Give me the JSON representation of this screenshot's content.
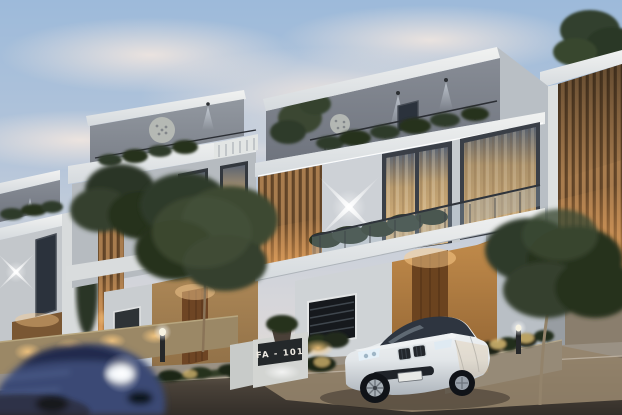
{
  "scene": {
    "description": "Dusk exterior rendering of a modern gated villa community with warm landscape lighting, a white luxury sedan parked in a driveway and a motion-blurred blue car passing on the street",
    "sign": {
      "label": "FA - 101"
    },
    "palette": {
      "sky_top": "#9dbada",
      "sky_horizon": "#e9dfd6",
      "facade_white": "#f1f2f1",
      "facade_gray": "#878c95",
      "wood_slats": "#a87c4e",
      "window_warm": "#e0b97e",
      "accent_light_warm": "#ffcd86",
      "accent_light_cool": "#eef4fb",
      "foliage_dark": "#2f3a2a",
      "road": "#4a4239",
      "sedan_white": "#f5f7f8",
      "passing_car_blue": "#3b4a74",
      "plaque_bg": "#24282a",
      "plaque_text": "#f0ece4"
    }
  }
}
